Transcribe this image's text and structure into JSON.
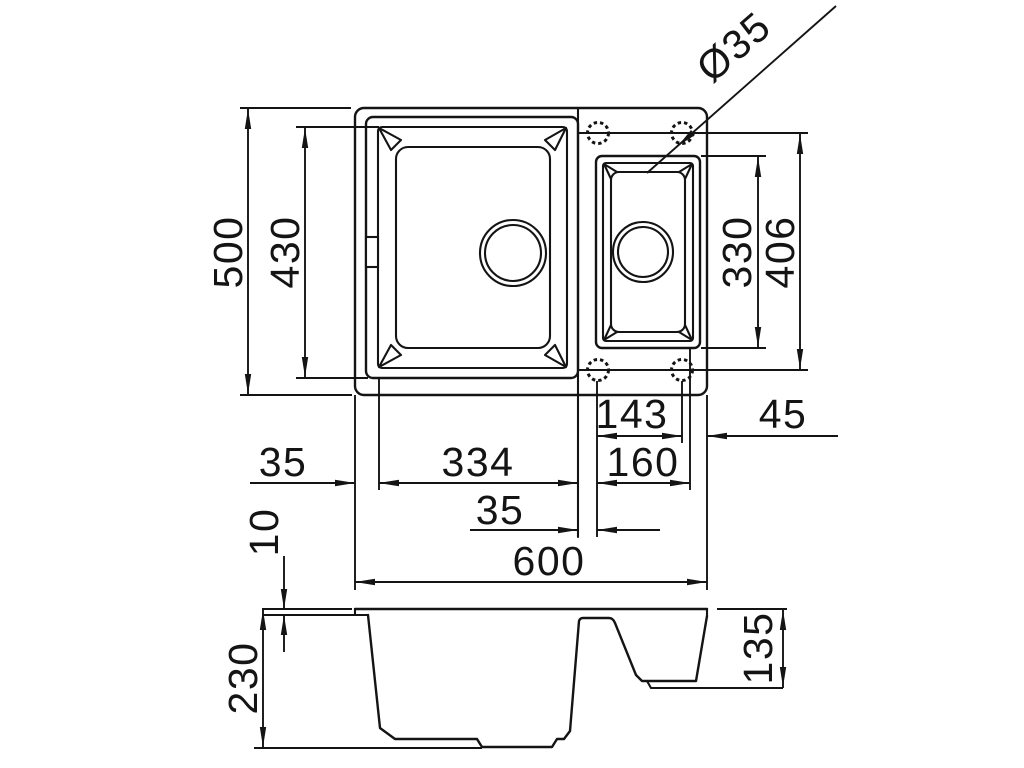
{
  "drawing": {
    "type": "kitchen-sink-technical-drawing",
    "background": "#ffffff",
    "line_color": "#141414",
    "top_view": {
      "overall_width": "600",
      "overall_depth": "500",
      "main_bowl_length": "430",
      "small_bowl_length": "330",
      "holes_span": "406",
      "holes_spacing": "143",
      "hole_edge_offset": "45",
      "left_offset": "35",
      "main_bowl_width": "334",
      "small_bowl_width": "160",
      "divider_width": "35",
      "hole_diameter": "Ø35"
    },
    "section_view": {
      "overall_height": "230",
      "rim_thickness": "10",
      "small_bowl_depth": "135"
    }
  }
}
